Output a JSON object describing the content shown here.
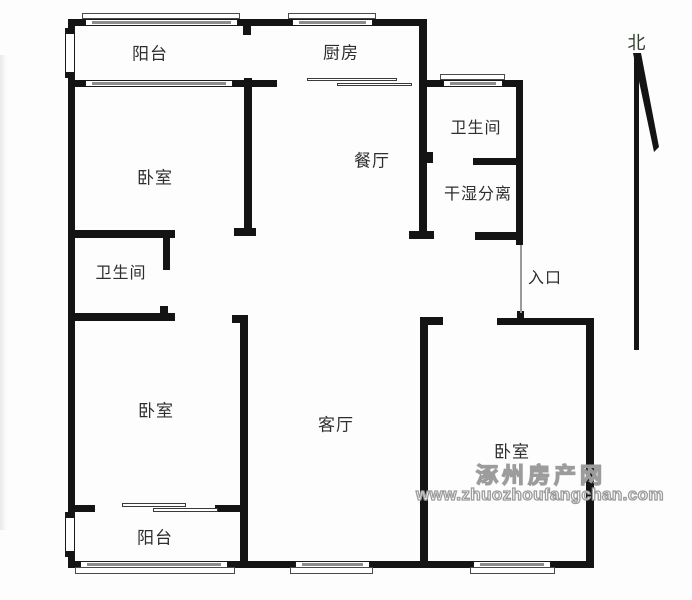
{
  "labels": {
    "balcony_top": "阳台",
    "kitchen": "厨房",
    "bathroom_top": "卫生间",
    "dining": "餐厅",
    "dry_wet": "干湿分离",
    "bedroom_nw": "卧室",
    "bathroom_w": "卫生间",
    "entrance": "入口",
    "bedroom_sw": "卧室",
    "living": "客厅",
    "bedroom_se": "卧室",
    "balcony_bottom": "阳台",
    "north": "北"
  },
  "watermark": {
    "site_name": "涿州房产网",
    "site_url": "www.zhuozhoufangchan.com"
  },
  "colors": {
    "wall": "#141414",
    "glass": "#8d8d8d",
    "watermark_outline": "#9c9c9c"
  }
}
